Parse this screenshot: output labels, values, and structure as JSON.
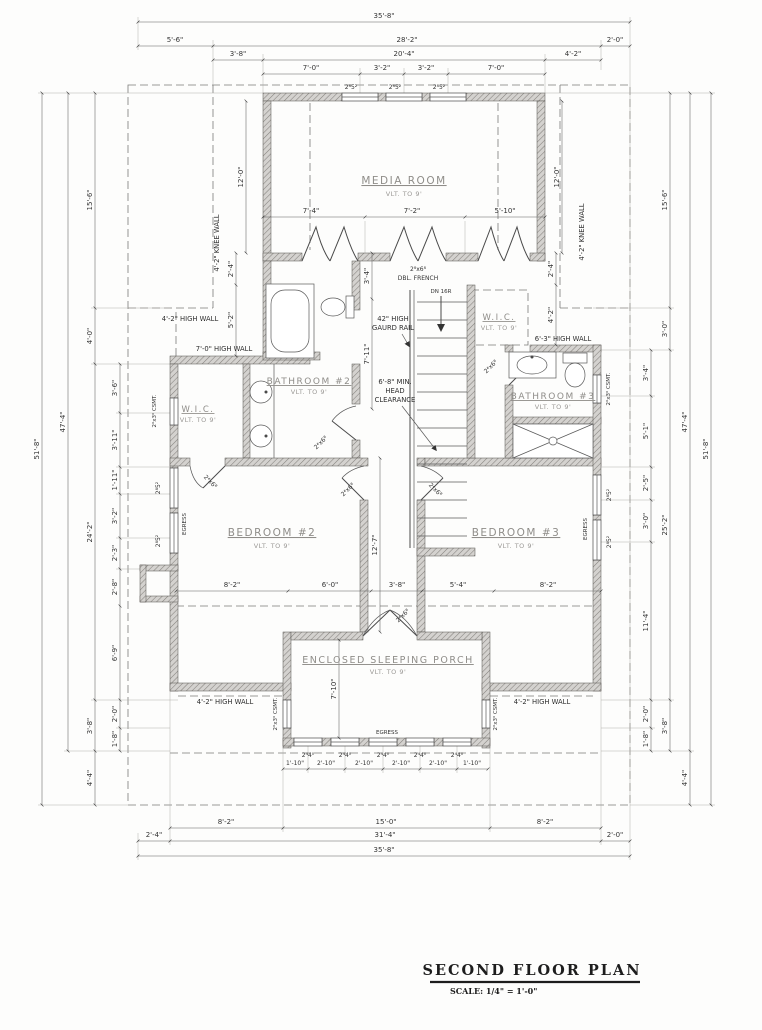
{
  "drawing": {
    "title": "SECOND FLOOR PLAN",
    "scale": "SCALE: 1/4\" = 1'-0\""
  },
  "rooms": {
    "media": {
      "name": "MEDIA ROOM",
      "note": "VLT. TO 9'"
    },
    "bath2": {
      "name": "BATHROOM #2",
      "note": "VLT. TO 9'"
    },
    "wic_left": {
      "name": "W.I.C.",
      "note": "VLT. TO 9'"
    },
    "wic_center": {
      "name": "W.I.C.",
      "note": "VLT. TO 9'"
    },
    "bath3": {
      "name": "BATHROOM #3",
      "note": "VLT. TO 9'"
    },
    "bed2": {
      "name": "BEDROOM #2",
      "note": "VLT. TO 9'"
    },
    "bed3": {
      "name": "BEDROOM #3",
      "note": "VLT. TO 9'"
    },
    "porch": {
      "name": "ENCLOSED SLEEPING PORCH",
      "note": "VLT. TO 9'"
    }
  },
  "notes": {
    "high_wall_tl": "4'-2\" HIGH WALL",
    "high_wall_bl": "4'-2\" HIGH WALL",
    "high_wall_br": "4'-2\" HIGH WALL",
    "high_wall_70": "7'-0\" HIGH WALL",
    "high_wall_63": "6'-3\" HIGH WALL",
    "knee_wall_left": "4'-2\" KNEE WALL",
    "knee_wall_right": "4'-2\" KNEE WALL",
    "guard_line1": "42\" HIGH",
    "guard_line2": "GAURD RAIL",
    "head_line1": "6'-8\" MIN.",
    "head_line2": "HEAD",
    "head_line3": "CLEARANCE",
    "stair_dn": "DN 16R",
    "egress": "EGRESS",
    "french_size": "2⁸x6⁸",
    "french_type": "DBL. FRENCH",
    "door_size": "2⁴x6⁸",
    "casement": "2⁰x3⁰ CSMT.",
    "window_egress": "2⁸5²",
    "window_porch": "2⁴4⁰"
  },
  "dims": {
    "top": [
      "35'-8\"",
      "5'-6\"",
      "28'-2\"",
      "2'-0\"",
      "3'-8\"",
      "20'-4\"",
      "4'-2\"",
      "7'-0\"",
      "3'-2\"",
      "3'-2\"",
      "7'-0\""
    ],
    "bottom": [
      "35'-8\"",
      "2'-4\"",
      "31'-4\"",
      "2'-0\"",
      "8'-2\"",
      "15'-0\"",
      "8'-2\"",
      "1'-10\"",
      "2'-10\"",
      "2'-10\"",
      "2'-10\"",
      "2'-10\"",
      "1'-10\""
    ],
    "left": [
      "51'-8\"",
      "47'-4\"",
      "15'-6\"",
      "4'-0\"",
      "24'-2\"",
      "3'-8\"",
      "4'-4\"",
      "3'-6\"",
      "3'-11\"",
      "1'-11\"",
      "3'-2\"",
      "2'-3\"",
      "2'-8\"",
      "6'-9\"",
      "2'-0\"",
      "1'-8\""
    ],
    "right": [
      "51'-8\"",
      "47'-4\"",
      "15'-6\"",
      "3'-0\"",
      "25'-2\"",
      "3'-8\"",
      "4'-4\"",
      "3'-4\"",
      "5'-1\"",
      "2'-5\"",
      "3'-0\"",
      "11'-4\"",
      "2'-0\"",
      "1'-8\""
    ],
    "interior": [
      "12'-0\"",
      "12'-0\"",
      "7'-4\"",
      "7'-2\"",
      "5'-10\"",
      "2'-4\"",
      "5'-2\"",
      "2'-4\"",
      "4'-2\"",
      "3'-4\"",
      "7'-11\"",
      "12'-7\"",
      "8'-2\"",
      "6'-0\"",
      "3'-8\"",
      "5'-4\"",
      "8'-2\"",
      "7'-10\""
    ]
  }
}
